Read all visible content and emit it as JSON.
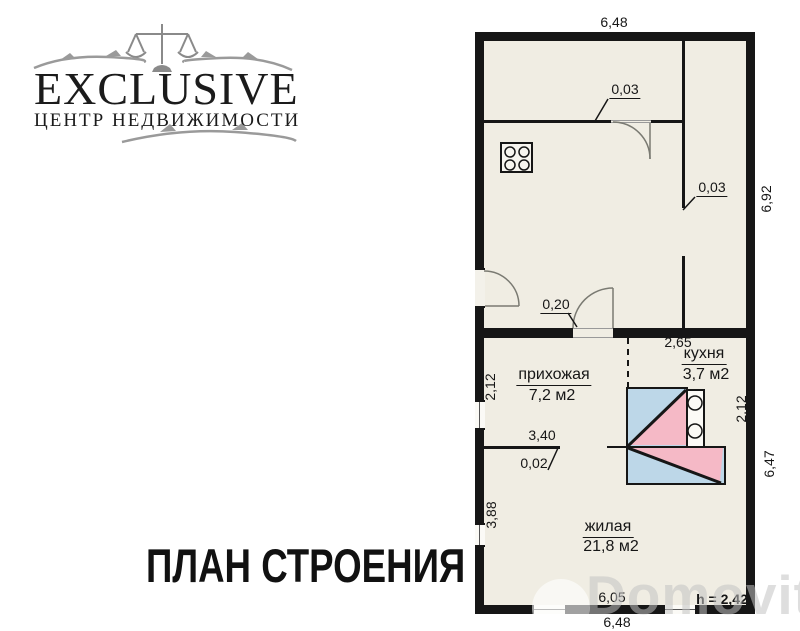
{
  "agency_logo": {
    "brand": "EXCLUSIVE",
    "tagline": "ЦЕНТР НЕДВИЖИМОСТИ"
  },
  "caption": "ПЛАН СТРОЕНИЯ",
  "watermark": "Domovita",
  "plan": {
    "rooms": {
      "hallway": {
        "name": "прихожая",
        "area": "7,2 м2"
      },
      "kitchen": {
        "name": "кухня",
        "area": "3,7 м2"
      },
      "living": {
        "name": "жилая",
        "area": "21,8 м2"
      }
    },
    "dims": {
      "top_width": "6,48",
      "bottom_width": "6,48",
      "annex_height": "6,92",
      "main_height": "6,47",
      "left_upper": "2,12",
      "left_lower": "3,88",
      "kitchen_depth": "2,12",
      "kitchen_width": "2,65",
      "living_width": "6,05",
      "hall_wall_len": "3,40",
      "partition_a": "0,03",
      "partition_b": "0,03",
      "entry_opening": "0,20",
      "hall_partition": "0,02",
      "ceiling_height": "h = 2,42"
    },
    "colors": {
      "furnace_blue": "#bdd7e8",
      "furnace_pink": "#f5b9c6",
      "floor": "#f0ede3",
      "wall": "#161616"
    }
  }
}
